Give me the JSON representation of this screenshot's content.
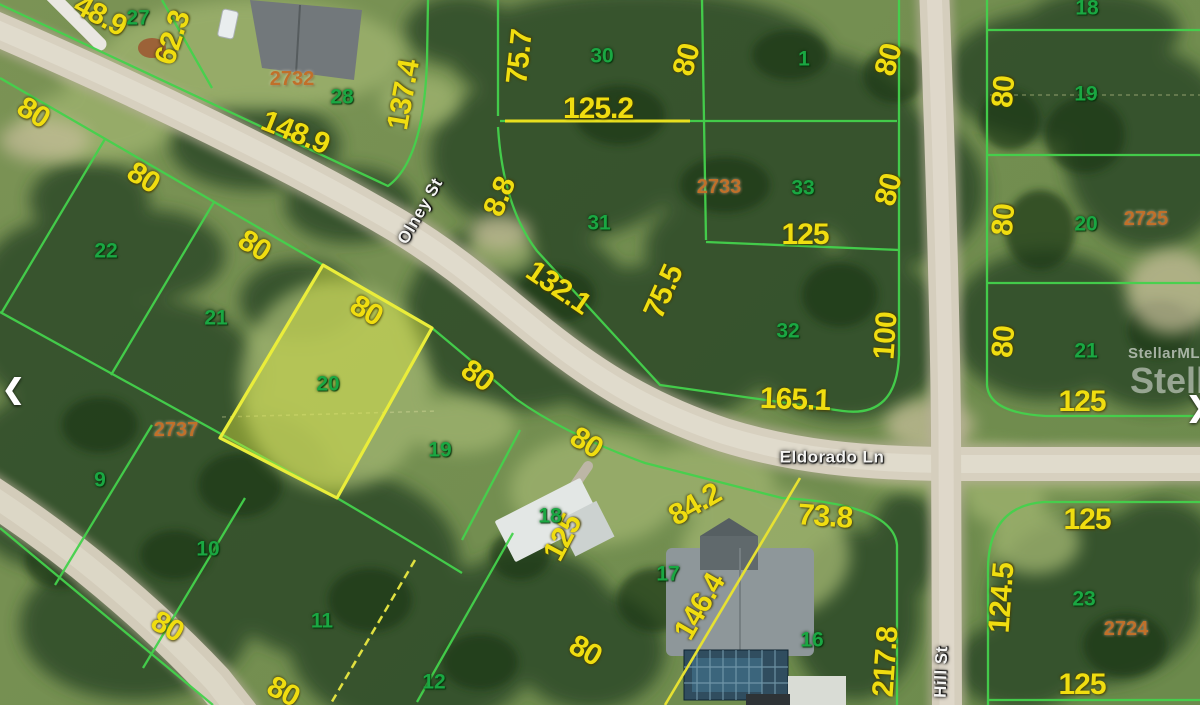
{
  "map": {
    "streets": [
      {
        "t": "Olney St",
        "x": 420,
        "y": 211,
        "r": -60
      },
      {
        "t": "Eldorado Ln",
        "x": 832,
        "y": 457,
        "r": 0
      },
      {
        "t": "Hill St",
        "x": 941,
        "y": 672,
        "r": -88
      }
    ],
    "dimensions": [
      {
        "t": "48.9",
        "x": 100,
        "y": 16,
        "r": 28
      },
      {
        "t": "62.3",
        "x": 173,
        "y": 38,
        "r": -72
      },
      {
        "t": "148.9",
        "x": 295,
        "y": 133,
        "r": 22
      },
      {
        "t": "137.4",
        "x": 404,
        "y": 95,
        "r": -80
      },
      {
        "t": "80",
        "x": 33,
        "y": 113,
        "r": 32
      },
      {
        "t": "80",
        "x": 143,
        "y": 178,
        "r": 32
      },
      {
        "t": "75.7",
        "x": 520,
        "y": 57,
        "r": -84
      },
      {
        "t": "80",
        "x": 687,
        "y": 60,
        "r": -75
      },
      {
        "t": "80",
        "x": 889,
        "y": 60,
        "r": -75
      },
      {
        "t": "125.2",
        "x": 598,
        "y": 109,
        "r": 0
      },
      {
        "t": "8.8",
        "x": 500,
        "y": 197,
        "r": -68
      },
      {
        "t": "80",
        "x": 889,
        "y": 190,
        "r": -75
      },
      {
        "t": "125",
        "x": 805,
        "y": 235,
        "r": 0
      },
      {
        "t": "132.1",
        "x": 558,
        "y": 288,
        "r": 34
      },
      {
        "t": "75.5",
        "x": 664,
        "y": 292,
        "r": -66
      },
      {
        "t": "100",
        "x": 886,
        "y": 336,
        "r": -86
      },
      {
        "t": "165.1",
        "x": 795,
        "y": 400,
        "r": 2
      },
      {
        "t": "80",
        "x": 254,
        "y": 246,
        "r": 32
      },
      {
        "t": "80",
        "x": 366,
        "y": 311,
        "r": 30
      },
      {
        "t": "80",
        "x": 477,
        "y": 376,
        "r": 35
      },
      {
        "t": "80",
        "x": 586,
        "y": 443,
        "r": 32
      },
      {
        "t": "80",
        "x": 167,
        "y": 627,
        "r": 30
      },
      {
        "t": "80",
        "x": 283,
        "y": 692,
        "r": 28
      },
      {
        "t": "80",
        "x": 585,
        "y": 651,
        "r": 30
      },
      {
        "t": "125",
        "x": 563,
        "y": 538,
        "r": -62
      },
      {
        "t": "84.2",
        "x": 695,
        "y": 505,
        "r": -30
      },
      {
        "t": "146.4",
        "x": 700,
        "y": 607,
        "r": -60
      },
      {
        "t": "73.8",
        "x": 825,
        "y": 517,
        "r": 4
      },
      {
        "t": "217.8",
        "x": 886,
        "y": 662,
        "r": -86
      },
      {
        "t": "80",
        "x": 1004,
        "y": 92,
        "r": -85
      },
      {
        "t": "80",
        "x": 1004,
        "y": 220,
        "r": -85
      },
      {
        "t": "80",
        "x": 1004,
        "y": 342,
        "r": -85
      },
      {
        "t": "125",
        "x": 1082,
        "y": 402,
        "r": 0
      },
      {
        "t": "125",
        "x": 1087,
        "y": 520,
        "r": 0
      },
      {
        "t": "124.5",
        "x": 1002,
        "y": 598,
        "r": -86
      },
      {
        "t": "125",
        "x": 1082,
        "y": 685,
        "r": 0
      }
    ],
    "lots": [
      {
        "t": "27",
        "x": 138,
        "y": 18
      },
      {
        "t": "28",
        "x": 342,
        "y": 97
      },
      {
        "t": "30",
        "x": 602,
        "y": 56
      },
      {
        "t": "1",
        "x": 804,
        "y": 59
      },
      {
        "t": "31",
        "x": 599,
        "y": 223
      },
      {
        "t": "33",
        "x": 803,
        "y": 188
      },
      {
        "t": "32",
        "x": 788,
        "y": 331
      },
      {
        "t": "22",
        "x": 106,
        "y": 251
      },
      {
        "t": "21",
        "x": 216,
        "y": 318
      },
      {
        "t": "20",
        "x": 328,
        "y": 384
      },
      {
        "t": "19",
        "x": 440,
        "y": 450
      },
      {
        "t": "9",
        "x": 100,
        "y": 480
      },
      {
        "t": "10",
        "x": 208,
        "y": 549
      },
      {
        "t": "11",
        "x": 322,
        "y": 621
      },
      {
        "t": "12",
        "x": 434,
        "y": 682
      },
      {
        "t": "18",
        "x": 550,
        "y": 516
      },
      {
        "t": "17",
        "x": 668,
        "y": 574
      },
      {
        "t": "16",
        "x": 812,
        "y": 640
      },
      {
        "t": "18",
        "x": 1087,
        "y": 8
      },
      {
        "t": "19",
        "x": 1086,
        "y": 94
      },
      {
        "t": "20",
        "x": 1086,
        "y": 224
      },
      {
        "t": "21",
        "x": 1086,
        "y": 351
      },
      {
        "t": "23",
        "x": 1084,
        "y": 599
      }
    ],
    "blocks": [
      {
        "t": "2732",
        "x": 292,
        "y": 79
      },
      {
        "t": "2733",
        "x": 719,
        "y": 187
      },
      {
        "t": "2737",
        "x": 176,
        "y": 430
      },
      {
        "t": "2725",
        "x": 1146,
        "y": 219
      },
      {
        "t": "2724",
        "x": 1126,
        "y": 629
      }
    ],
    "watermark": {
      "line1": "StellarMLS",
      "line2": "Stella"
    },
    "nav": {
      "prev": "❮",
      "next": "❯"
    },
    "highlight": {
      "lot": "20",
      "fill": "#dee63e",
      "outline": "#eaed3a"
    },
    "colors": {
      "dimension_text": "#f0dd10",
      "lot_text": "#1aa742",
      "block_text": "#c0702a",
      "parcel_line": "#44d24c",
      "road": "#d7d0bf"
    }
  }
}
